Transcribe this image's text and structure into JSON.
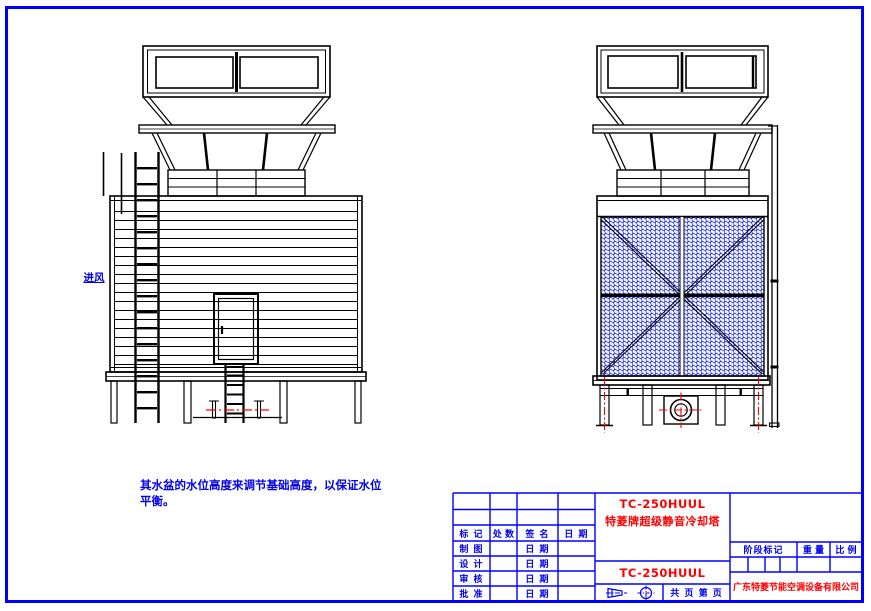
{
  "page": {
    "frame_color": "#0000ff",
    "background": "#ffffff"
  },
  "annotations": {
    "air_inlet_label": "进风",
    "note_line1": "其水盆的水位高度来调节基础高度，以保证水位",
    "note_line2": "平衡。"
  },
  "title_block": {
    "revision_headers": [
      "标 记",
      "处 数",
      "签 名",
      "日 期"
    ],
    "approval_rows": [
      {
        "label": "制 图",
        "date": "日 期"
      },
      {
        "label": "设 计",
        "date": "日 期"
      },
      {
        "label": "审 核",
        "date": "日 期"
      },
      {
        "label": "批 准",
        "date": "日 期"
      }
    ],
    "model": "TC-250HUUL",
    "product_name": "特菱牌超级静音冷却塔",
    "model_repeat": "TC-250HUUL",
    "stage_header": "阶段标记",
    "weight_header": "重 量",
    "scale_header": "比 例",
    "pages_label": "共 页 第 页",
    "company": "广东特菱节能空调设备有限公司",
    "colors": {
      "table_line": "#0000ff",
      "title_text": "#ff0000",
      "label_text": "#0000ee",
      "mesh": "#0011dd",
      "centerline": "#ff0000"
    }
  }
}
